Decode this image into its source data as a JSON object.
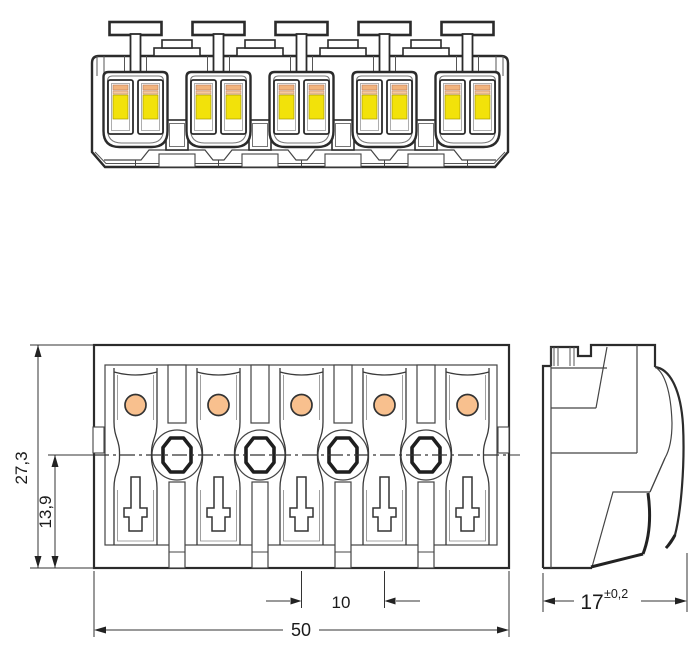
{
  "drawing": {
    "type": "technical-line-drawing",
    "views": {
      "front": {
        "label": "front elevation",
        "pole_count": 5,
        "push_buttons": 5
      },
      "plan": {
        "label": "top view",
        "pole_count": 5,
        "test_ports": 4
      },
      "side": {
        "label": "side profile"
      }
    },
    "dimensions": {
      "overall_depth": {
        "value": "27,3"
      },
      "centerline_offset": {
        "value": "13,9"
      },
      "pole_pitch": {
        "value": "10"
      },
      "overall_width": {
        "value": "50"
      },
      "housing_width": {
        "value": "17",
        "tolerance": "±0,2"
      }
    },
    "colors": {
      "line": "#2b2b2b",
      "contact_yellow": "#f2e20a",
      "clamp_stripe_orange": "#f2b47e",
      "clamp_stripe_orange_light": "#f6c99e",
      "hole_peach": "#f8c08e",
      "background": "#ffffff"
    }
  }
}
